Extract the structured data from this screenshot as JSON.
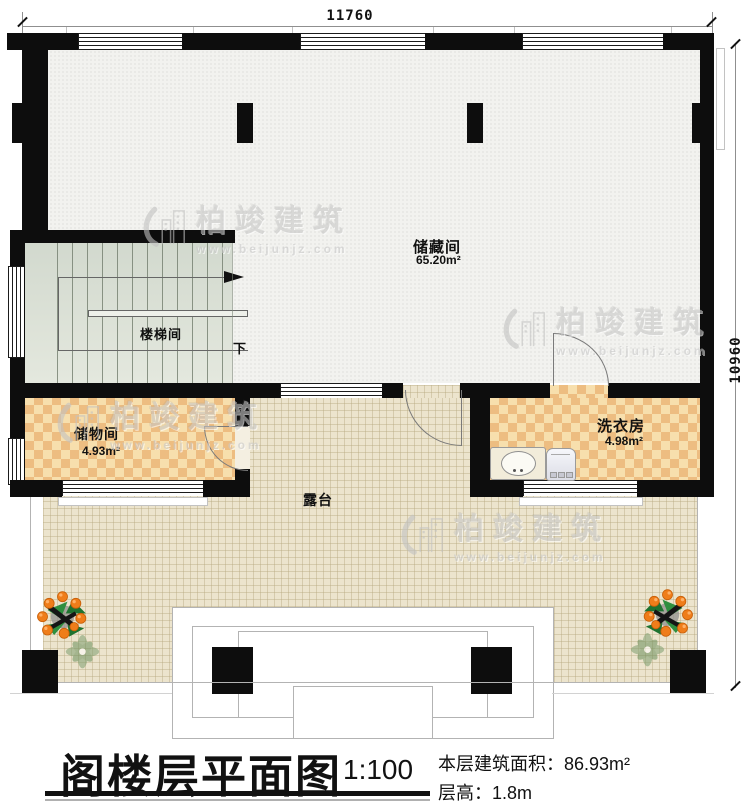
{
  "title": {
    "text": "阁楼层平面图",
    "scale": "1:100",
    "area_label": "本层建筑面积：",
    "area_value": "86.93m²",
    "floor_height_label": "层高：",
    "floor_height_value": "1.8m"
  },
  "dimensions": {
    "width_top": "11760",
    "height_right": "10960"
  },
  "rooms": {
    "storage": {
      "name": "储藏间",
      "area": "65.20m²"
    },
    "stairwell": {
      "name": "楼梯间",
      "down": "下"
    },
    "closet": {
      "name": "储物间",
      "area": "4.93m²"
    },
    "laundry": {
      "name": "洗衣房",
      "area": "4.98m²"
    },
    "terrace": {
      "name": "露台"
    }
  },
  "watermark": {
    "brand": "柏竣建筑",
    "url": "www.beijunjz.com"
  },
  "colors": {
    "wall": "#0d0d0d",
    "terrace_floor": "#ece4cd",
    "tile_light": "#f7dfad",
    "tile_dark": "#edbd81",
    "stair_floor": "#dde3d8",
    "storage_floor": "#f2f2ef",
    "fruit": "#ef7d1a"
  }
}
